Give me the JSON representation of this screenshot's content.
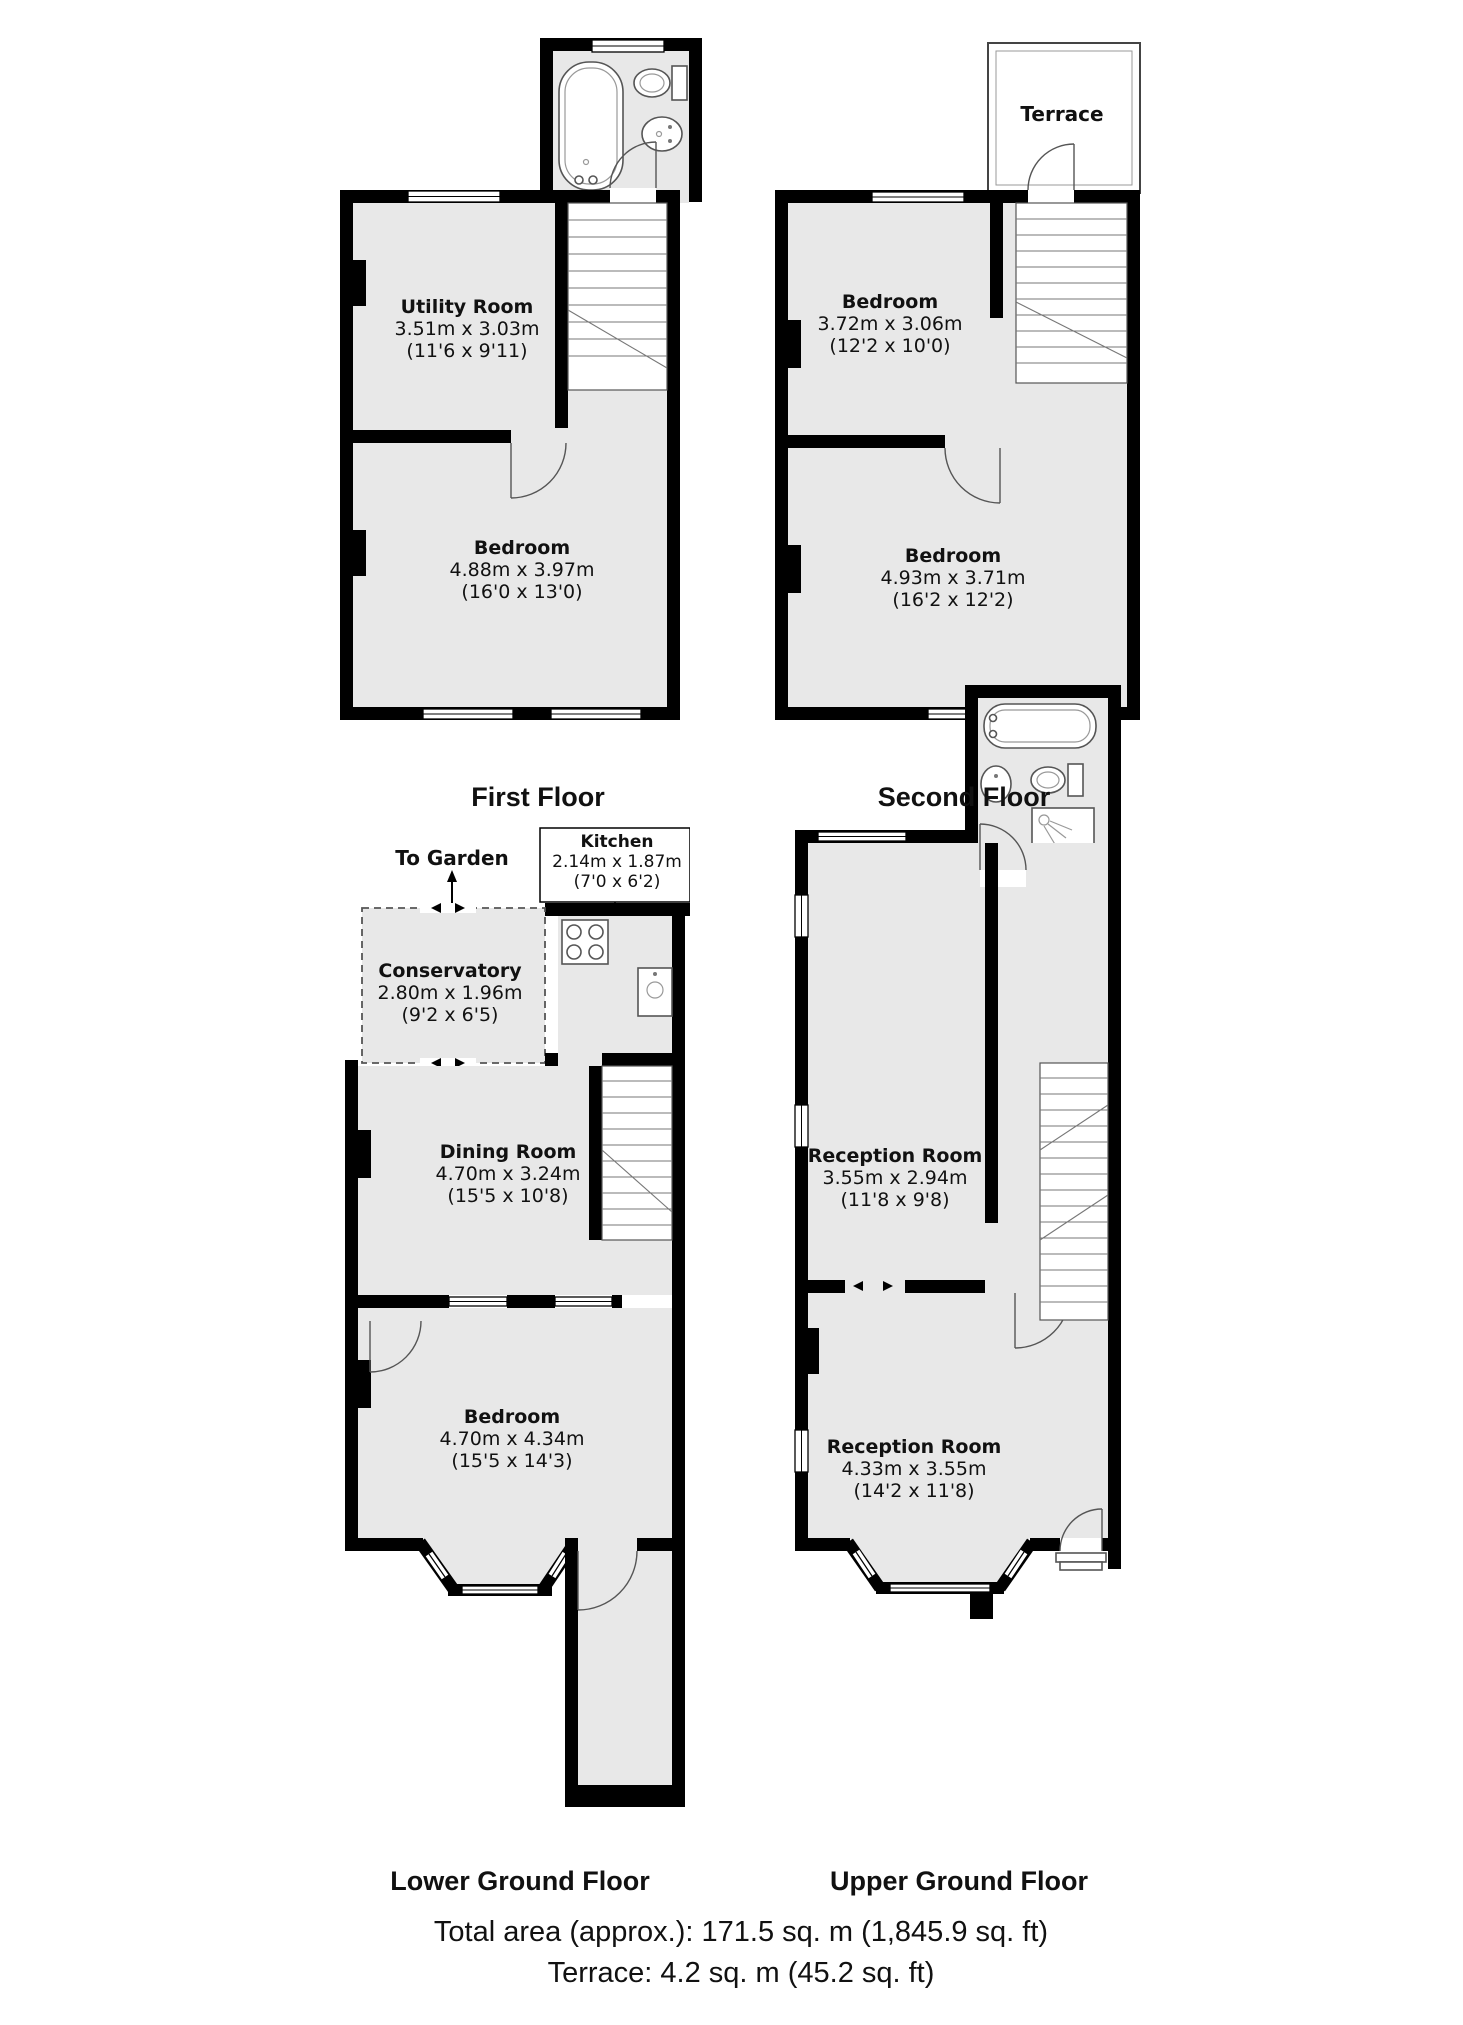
{
  "colors": {
    "wall": "#000000",
    "room_fill": "#e8e8e8",
    "background": "#ffffff"
  },
  "floors": {
    "first": {
      "title": "First Floor",
      "rooms": {
        "utility": {
          "name": "Utility Room",
          "metric": "3.51m x 3.03m",
          "imperial": "(11'6 x 9'11)"
        },
        "bedroom": {
          "name": "Bedroom",
          "metric": "4.88m x 3.97m",
          "imperial": "(16'0 x 13'0)"
        }
      }
    },
    "second": {
      "title": "Second Floor",
      "terrace_label": "Terrace",
      "rooms": {
        "bedroom_front": {
          "name": "Bedroom",
          "metric": "3.72m x 3.06m",
          "imperial": "(12'2 x 10'0)"
        },
        "bedroom_back": {
          "name": "Bedroom",
          "metric": "4.93m x 3.71m",
          "imperial": "(16'2 x 12'2)"
        }
      }
    },
    "lower_ground": {
      "title": "Lower Ground Floor",
      "to_garden_label": "To Garden",
      "rooms": {
        "kitchen": {
          "name": "Kitchen",
          "metric": "2.14m x 1.87m",
          "imperial": "(7'0 x 6'2)"
        },
        "conservatory": {
          "name": "Conservatory",
          "metric": "2.80m x 1.96m",
          "imperial": "(9'2 x 6'5)"
        },
        "dining": {
          "name": "Dining Room",
          "metric": "4.70m x 3.24m",
          "imperial": "(15'5 x 10'8)"
        },
        "bedroom": {
          "name": "Bedroom",
          "metric": "4.70m x 4.34m",
          "imperial": "(15'5 x 14'3)"
        }
      }
    },
    "upper_ground": {
      "title": "Upper Ground Floor",
      "rooms": {
        "reception_front": {
          "name": "Reception Room",
          "metric": "3.55m x 2.94m",
          "imperial": "(11'8 x 9'8)"
        },
        "reception_back": {
          "name": "Reception Room",
          "metric": "4.33m x 3.55m",
          "imperial": "(14'2 x 11'8)"
        }
      }
    }
  },
  "footer": {
    "total_area": "Total area (approx.): 171.5 sq. m (1,845.9 sq. ft)",
    "terrace_area": "Terrace: 4.2 sq. m (45.2 sq. ft)"
  }
}
